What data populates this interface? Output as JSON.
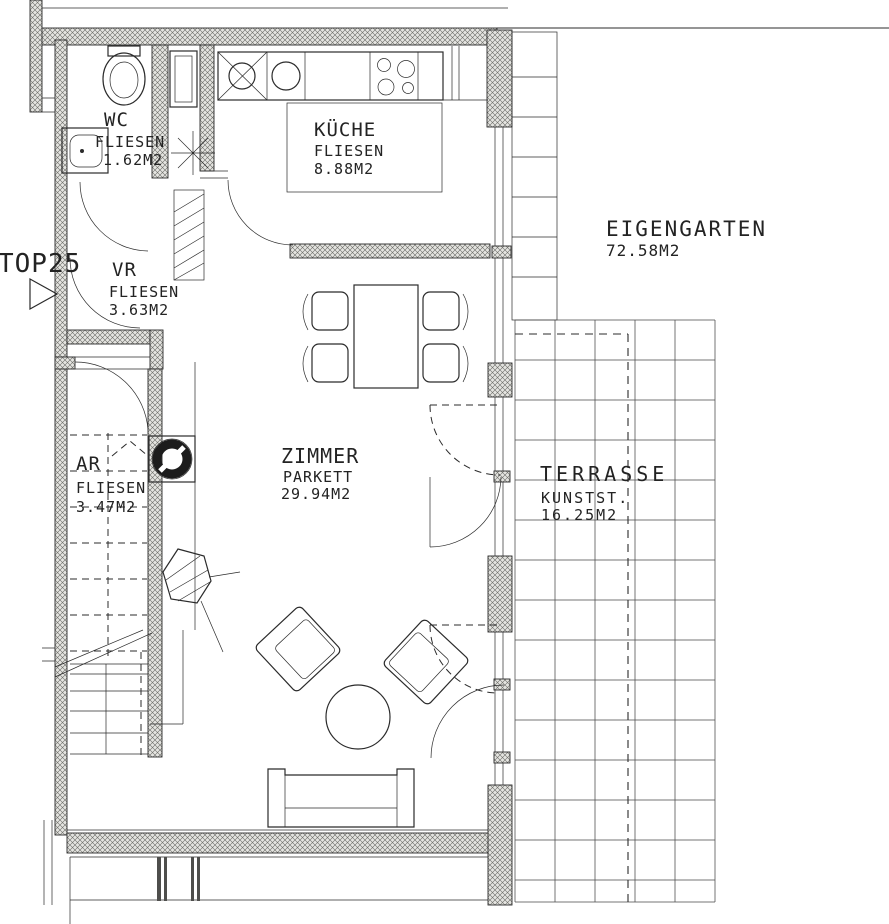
{
  "plan": {
    "unit": "TOP25",
    "rooms": {
      "wc": {
        "name": "WC",
        "floor": "FLIESEN",
        "area": "1.62M2"
      },
      "kueche": {
        "name": "KÜCHE",
        "floor": "FLIESEN",
        "area": "8.88M2"
      },
      "vr": {
        "name": "VR",
        "floor": "FLIESEN",
        "area": "3.63M2"
      },
      "ar": {
        "name": "AR",
        "floor": "FLIESEN",
        "area": "3.47M2"
      },
      "zimmer": {
        "name": "ZIMMER",
        "floor": "PARKETT",
        "area": "29.94M2"
      },
      "eigengarten": {
        "name": "EIGENGARTEN",
        "area": "72.58M2"
      },
      "terrasse": {
        "name": "TERRASSE",
        "floor": "KUNSTST.",
        "area": "16.25M2"
      }
    }
  },
  "colors": {
    "ink": "#2b2b2b",
    "paper": "#ffffff",
    "wall_fill": "#e4e4e0",
    "grid_line": "#4a4a4a"
  }
}
